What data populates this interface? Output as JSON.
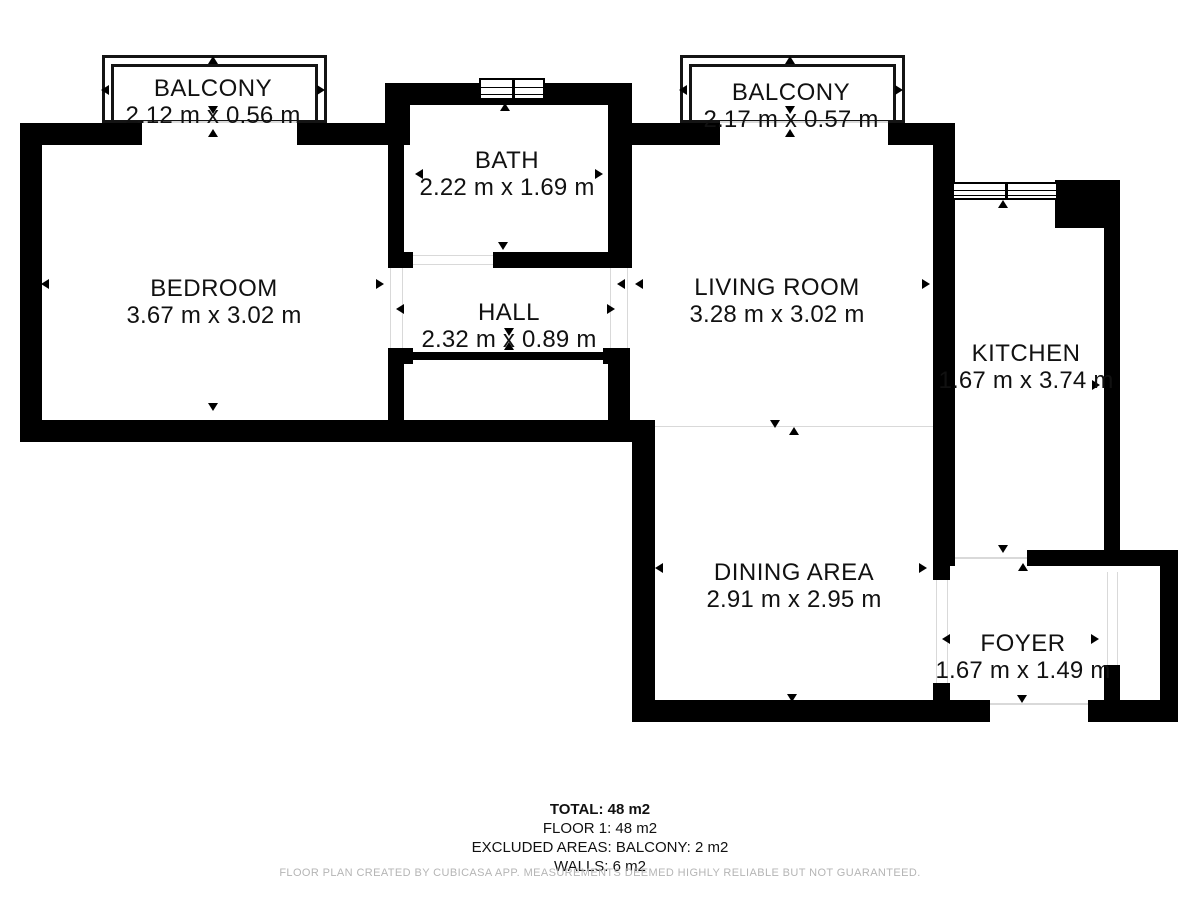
{
  "summary": {
    "total": "TOTAL: 48 m2",
    "floor1": "FLOOR 1: 48 m2",
    "excluded": "EXCLUDED AREAS: BALCONY: 2 m2",
    "walls": "WALLS: 6 m2"
  },
  "footer": "FLOOR PLAN CREATED BY CUBICASA APP. MEASUREMENTS DEEMED HIGHLY RELIABLE BUT NOT GUARANTEED.",
  "colors": {
    "wall": "#000000",
    "background": "#ffffff",
    "footer_text": "#b5b5b5",
    "threshold": "#d9d9d9"
  },
  "plan": {
    "rooms": [
      {
        "id": "balcony-left",
        "name": "BALCONY",
        "dims": "2.12 m x 0.56 m",
        "x": 213,
        "y": 89
      },
      {
        "id": "bedroom",
        "name": "BEDROOM",
        "dims": "3.67 m x 3.02 m",
        "x": 214,
        "y": 289
      },
      {
        "id": "bath",
        "name": "BATH",
        "dims": "2.22 m x 1.69 m",
        "x": 507,
        "y": 161
      },
      {
        "id": "hall",
        "name": "HALL",
        "dims": "2.32 m x 0.89 m",
        "x": 509,
        "y": 313
      },
      {
        "id": "balcony-right",
        "name": "BALCONY",
        "dims": "2.17 m x 0.57 m",
        "x": 791,
        "y": 93
      },
      {
        "id": "living-room",
        "name": "LIVING ROOM",
        "dims": "3.28 m x 3.02 m",
        "x": 777,
        "y": 288
      },
      {
        "id": "kitchen",
        "name": "KITCHEN",
        "dims": "1.67 m x 3.74 m",
        "x": 1026,
        "y": 354
      },
      {
        "id": "dining-area",
        "name": "DINING AREA",
        "dims": "2.91 m x 2.95 m",
        "x": 794,
        "y": 573
      },
      {
        "id": "foyer",
        "name": "FOYER",
        "dims": "1.67 m x 1.49 m",
        "x": 1023,
        "y": 644
      }
    ],
    "walls": [
      [
        20,
        123,
        22,
        314
      ],
      [
        20,
        123,
        122,
        22
      ],
      [
        297,
        123,
        113,
        22
      ],
      [
        20,
        420,
        635,
        22
      ],
      [
        388,
        123,
        16,
        145
      ],
      [
        388,
        252,
        25,
        16
      ],
      [
        388,
        348,
        16,
        72
      ],
      [
        388,
        348,
        25,
        16
      ],
      [
        385,
        83,
        25,
        45
      ],
      [
        388,
        83,
        244,
        22
      ],
      [
        608,
        83,
        24,
        185
      ],
      [
        493,
        252,
        137,
        16
      ],
      [
        608,
        348,
        22,
        72
      ],
      [
        603,
        348,
        27,
        16
      ],
      [
        413,
        352,
        195,
        8
      ],
      [
        608,
        123,
        112,
        22
      ],
      [
        888,
        123,
        67,
        22
      ],
      [
        933,
        123,
        22,
        443
      ],
      [
        1055,
        180,
        65,
        48
      ],
      [
        1104,
        228,
        16,
        322
      ],
      [
        1027,
        550,
        151,
        16
      ],
      [
        1160,
        550,
        18,
        172
      ],
      [
        933,
        566,
        17,
        14
      ],
      [
        933,
        683,
        17,
        28
      ],
      [
        1104,
        665,
        16,
        46
      ],
      [
        632,
        420,
        23,
        302
      ],
      [
        632,
        700,
        358,
        22
      ],
      [
        1088,
        700,
        90,
        22
      ]
    ],
    "railings": [
      [
        102,
        55,
        225,
        68
      ],
      [
        111,
        64,
        207,
        59
      ],
      [
        680,
        55,
        225,
        68
      ],
      [
        689,
        64,
        207,
        59
      ]
    ],
    "windows": [
      [
        479,
        78,
        66,
        22
      ],
      [
        952,
        182,
        106,
        18
      ]
    ],
    "thresholds": [
      [
        142,
        121,
        155,
        2
      ],
      [
        720,
        121,
        168,
        2
      ],
      [
        390,
        268,
        1,
        80
      ],
      [
        402,
        268,
        1,
        80
      ],
      [
        610,
        268,
        1,
        80
      ],
      [
        627,
        268,
        1,
        80
      ],
      [
        413,
        255,
        80,
        1
      ],
      [
        413,
        264,
        80,
        1
      ],
      [
        950,
        557,
        77,
        2
      ],
      [
        936,
        580,
        1,
        103
      ],
      [
        947,
        580,
        1,
        103
      ],
      [
        1107,
        572,
        1,
        93
      ],
      [
        1117,
        572,
        1,
        93
      ],
      [
        990,
        703,
        98,
        2
      ],
      [
        655,
        426,
        278,
        1
      ]
    ],
    "arrows": [
      [
        213,
        60,
        "up"
      ],
      [
        106,
        89,
        "left"
      ],
      [
        322,
        89,
        "right"
      ],
      [
        213,
        110,
        "down"
      ],
      [
        213,
        133,
        "up"
      ],
      [
        46,
        283,
        "left"
      ],
      [
        381,
        283,
        "right"
      ],
      [
        213,
        407,
        "down"
      ],
      [
        401,
        308,
        "left"
      ],
      [
        505,
        107,
        "up"
      ],
      [
        420,
        173,
        "left"
      ],
      [
        600,
        173,
        "right"
      ],
      [
        503,
        246,
        "down"
      ],
      [
        503,
        261,
        "up"
      ],
      [
        622,
        283,
        "left"
      ],
      [
        612,
        308,
        "right"
      ],
      [
        509,
        332,
        "down"
      ],
      [
        509,
        346,
        "up"
      ],
      [
        790,
        60,
        "up"
      ],
      [
        684,
        89,
        "left"
      ],
      [
        900,
        89,
        "right"
      ],
      [
        790,
        110,
        "down"
      ],
      [
        790,
        133,
        "up"
      ],
      [
        640,
        283,
        "left"
      ],
      [
        927,
        283,
        "right"
      ],
      [
        775,
        424,
        "down"
      ],
      [
        794,
        431,
        "up"
      ],
      [
        1003,
        204,
        "up"
      ],
      [
        951,
        384,
        "left"
      ],
      [
        1097,
        384,
        "right"
      ],
      [
        660,
        567,
        "left"
      ],
      [
        924,
        567,
        "right"
      ],
      [
        792,
        698,
        "down"
      ],
      [
        1003,
        549,
        "down"
      ],
      [
        1023,
        567,
        "up"
      ],
      [
        947,
        638,
        "left"
      ],
      [
        1096,
        638,
        "right"
      ],
      [
        1022,
        699,
        "down"
      ]
    ]
  }
}
